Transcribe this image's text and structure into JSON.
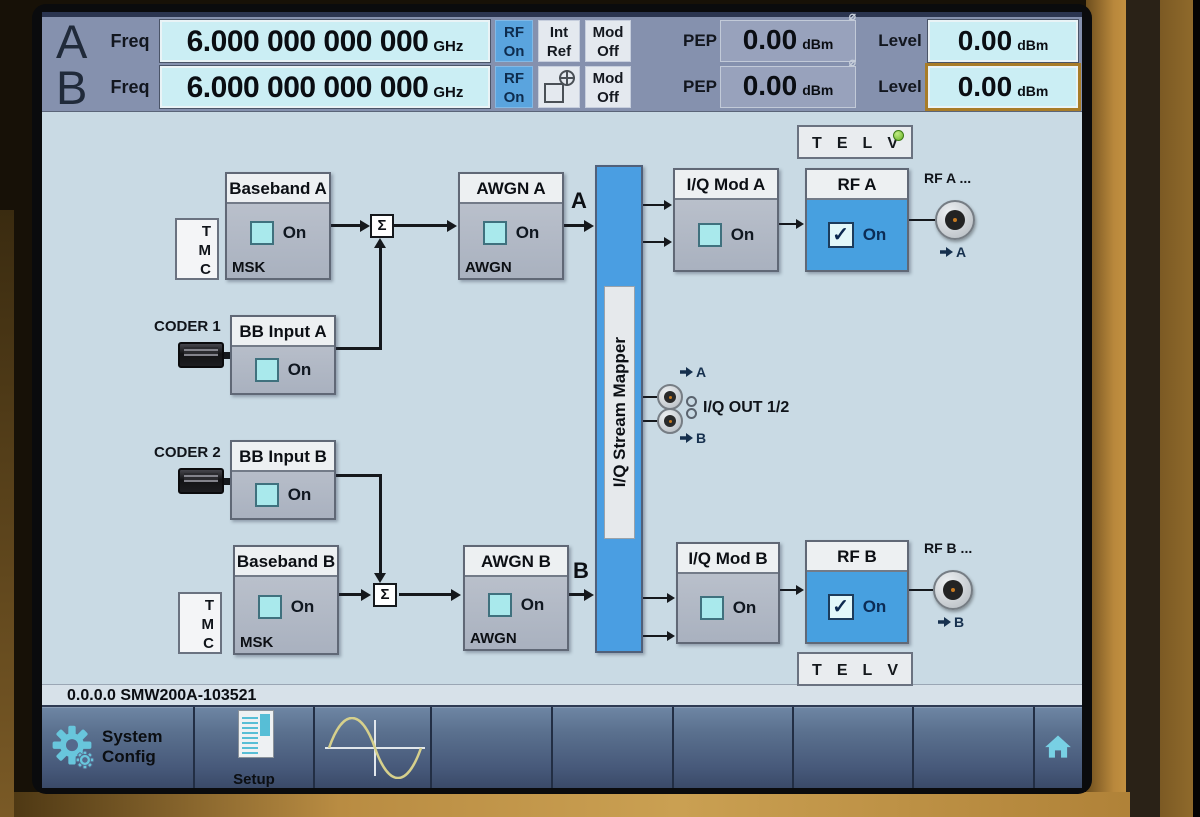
{
  "header": {
    "row_a": {
      "channel": "A",
      "freq_label": "Freq",
      "freq_value": "6.000 000 000 000",
      "freq_unit": "GHz",
      "rf_line1": "RF",
      "rf_line2": "On",
      "ref_line1": "Int",
      "ref_line2": "Ref",
      "mod_line1": "Mod",
      "mod_line2": "Off",
      "pep_label": "PEP",
      "pep_value": "0.00",
      "pep_unit": "dBm",
      "level_label": "Level",
      "level_value": "0.00",
      "level_unit": "dBm"
    },
    "row_b": {
      "channel": "B",
      "freq_label": "Freq",
      "freq_value": "6.000 000 000 000",
      "freq_unit": "GHz",
      "rf_line1": "RF",
      "rf_line2": "On",
      "mod_line1": "Mod",
      "mod_line2": "Off",
      "pep_label": "PEP",
      "pep_value": "0.00",
      "pep_unit": "dBm",
      "level_label": "Level",
      "level_value": "0.00",
      "level_unit": "dBm"
    }
  },
  "diagram": {
    "tmc": [
      "T",
      "M",
      "C"
    ],
    "telv": [
      "T",
      "E",
      "L",
      "V"
    ],
    "coder1_label": "CODER 1",
    "coder2_label": "CODER 2",
    "baseband_a": {
      "title": "Baseband A",
      "on_label": "On",
      "sub": "MSK"
    },
    "baseband_b": {
      "title": "Baseband B",
      "on_label": "On",
      "sub": "MSK"
    },
    "bb_input_a": {
      "title": "BB Input A",
      "on_label": "On"
    },
    "bb_input_b": {
      "title": "BB Input B",
      "on_label": "On"
    },
    "awgn_a": {
      "title": "AWGN A",
      "on_label": "On",
      "sub": "AWGN"
    },
    "awgn_b": {
      "title": "AWGN B",
      "on_label": "On",
      "sub": "AWGN"
    },
    "iq_mod_a": {
      "title": "I/Q Mod A",
      "on_label": "On"
    },
    "iq_mod_b": {
      "title": "I/Q Mod B",
      "on_label": "On"
    },
    "rf_a": {
      "title": "RF A",
      "on_label": "On"
    },
    "rf_b": {
      "title": "RF B",
      "on_label": "On"
    },
    "mapper_label": "I/Q Stream Mapper",
    "sigma": "Σ",
    "checkmark": "✓",
    "stream_a": "A",
    "stream_b": "B",
    "out_a": "A",
    "out_b": "B",
    "iq_out_label": "I/Q OUT 1/2",
    "rf_a_connector": "RF A ...",
    "rf_b_connector": "RF B ..."
  },
  "statusbar": {
    "text": "0.0.0.0 SMW200A-103521"
  },
  "taskbar": {
    "system_config_line1": "System",
    "system_config_line2": "Config",
    "setup_label": "Setup"
  },
  "icons": {
    "pep_corner": "⌀",
    "gear": "⚙",
    "setup_window": "▤",
    "sine_wave": "∿",
    "home": "⌂",
    "constellation": "⊕",
    "led": "●",
    "arrow_right": "➡"
  },
  "colors": {
    "accent_blue": "#47a0e0",
    "field_cyan": "#cbeef4",
    "focus_border": "#a87c28",
    "led_green": "#68b226",
    "header_slate": "#8591ae",
    "diagram_bg": "#c9dae4"
  }
}
